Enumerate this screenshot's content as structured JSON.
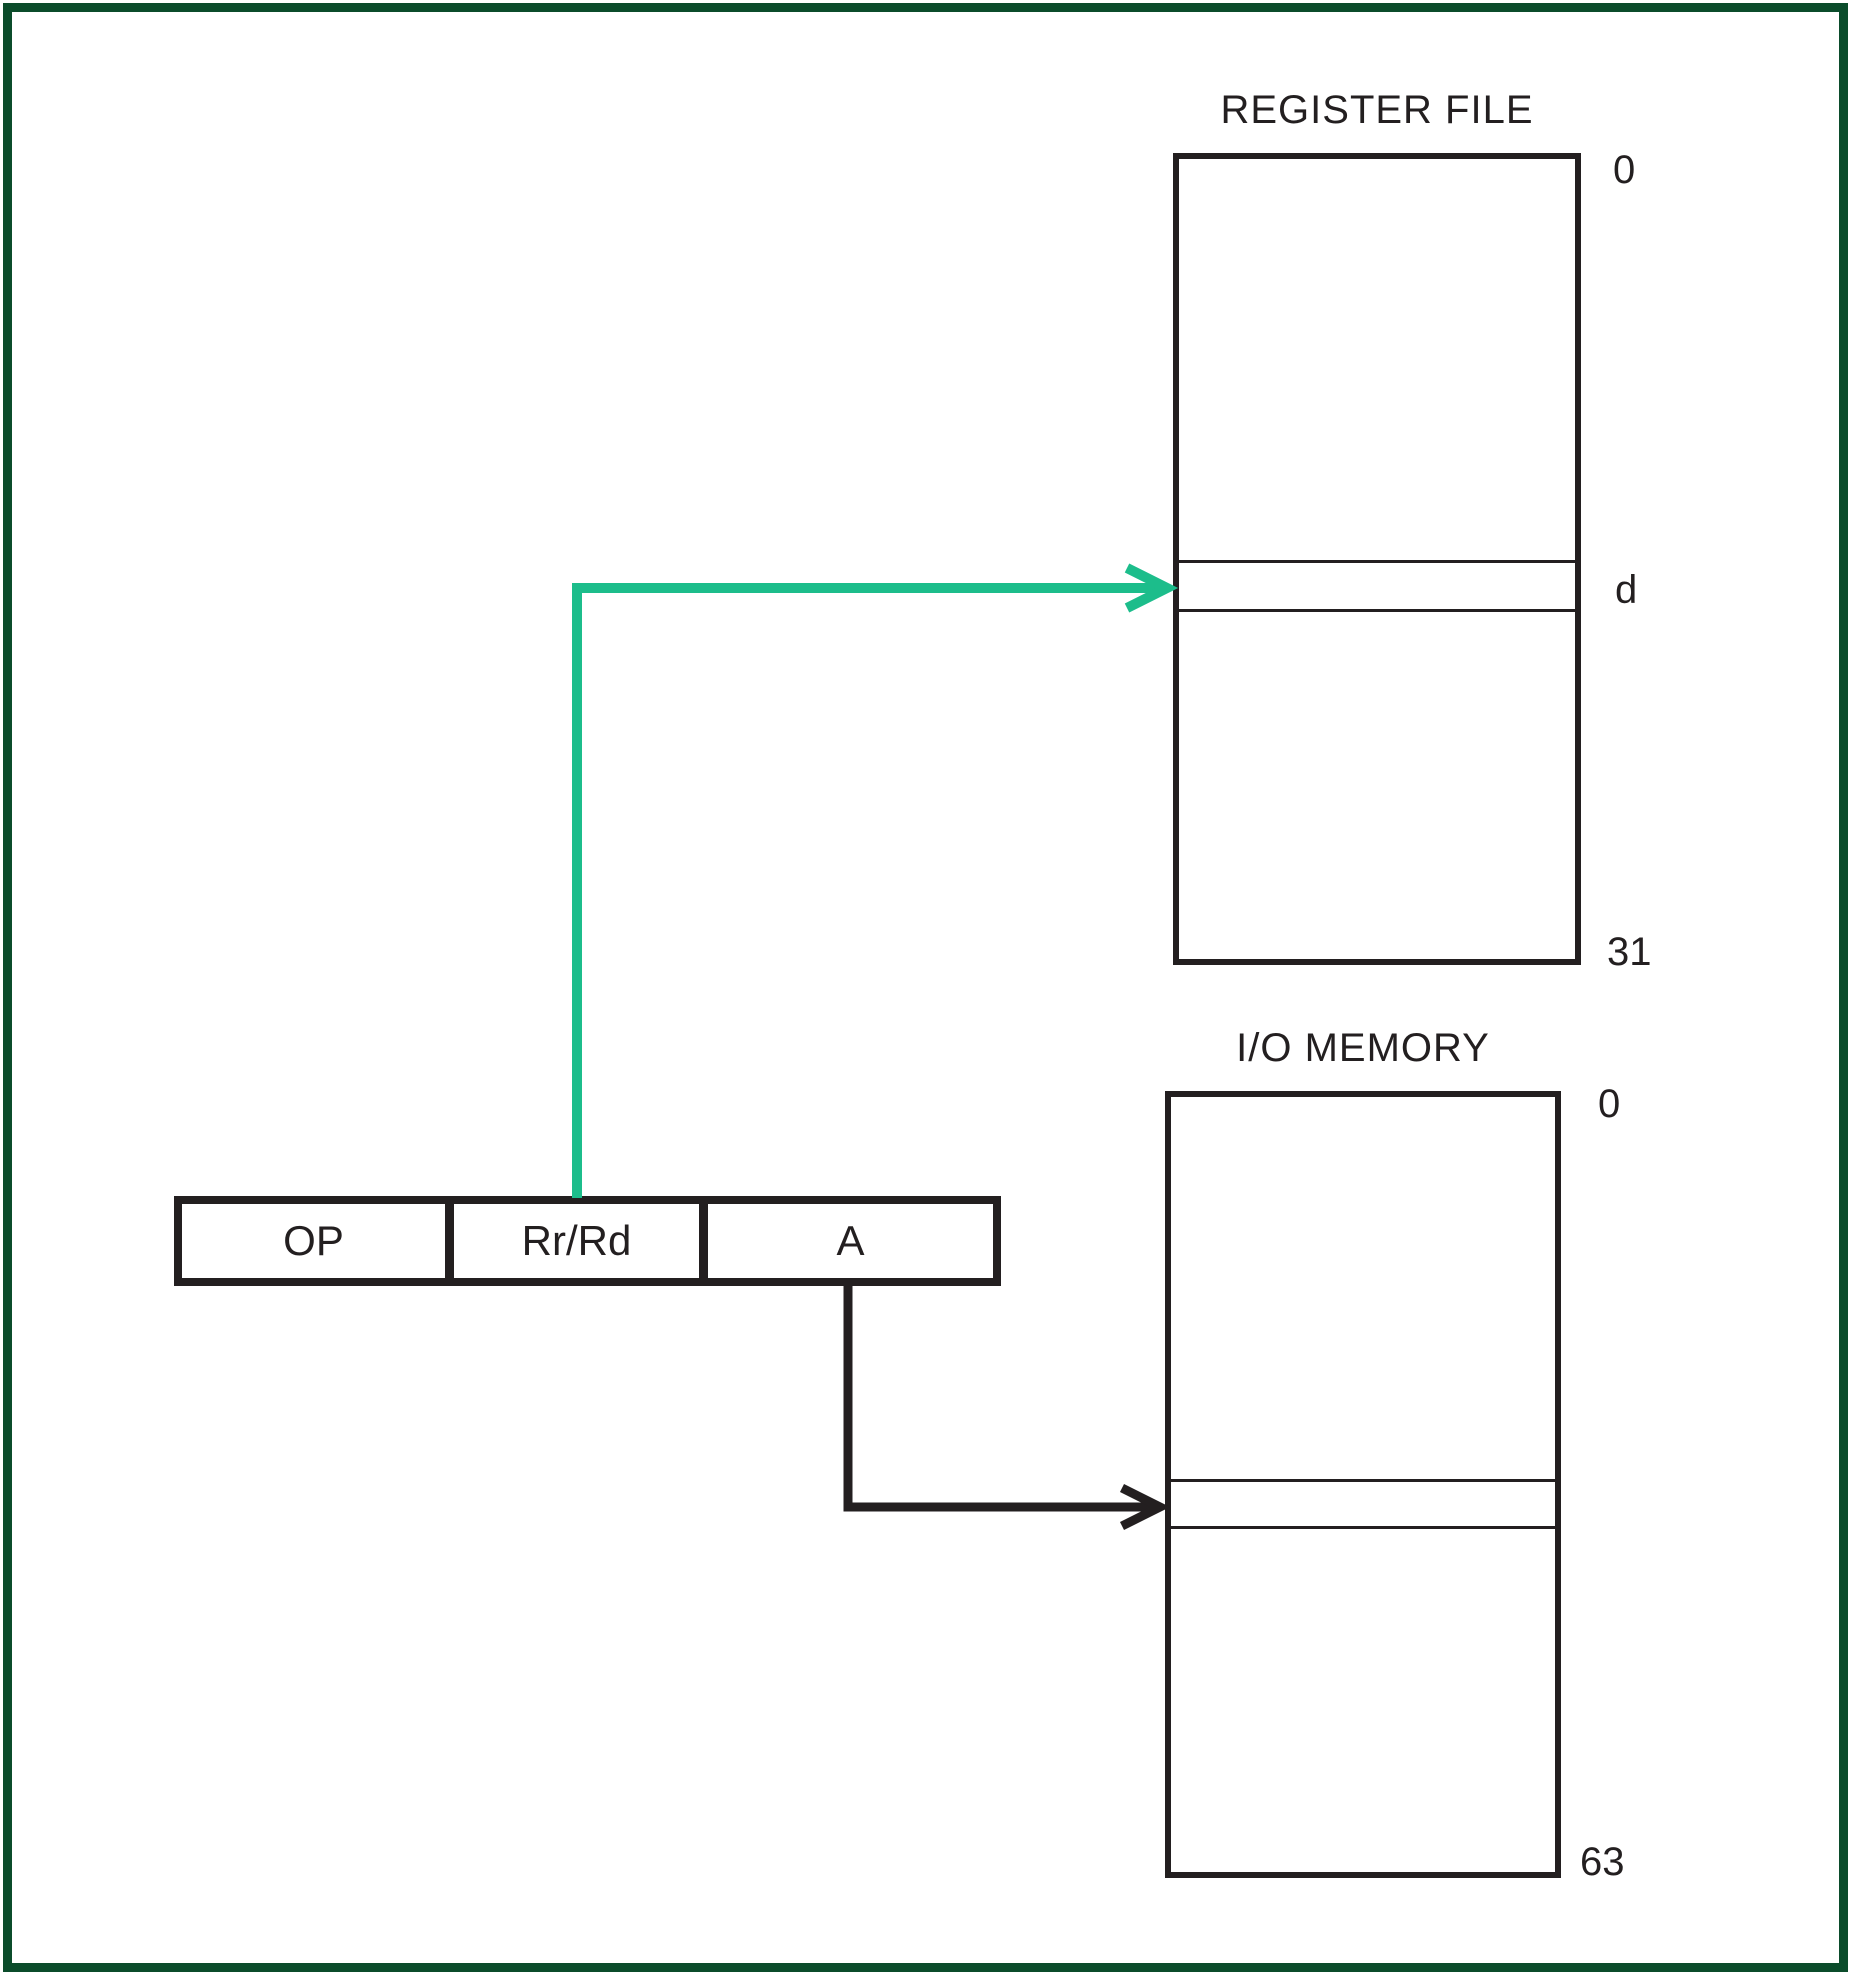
{
  "colors": {
    "frame_green": "#0b4c2b",
    "accent_green": "#1cbd8b",
    "line_black": "#231f20"
  },
  "register_file": {
    "title": "REGISTER FILE",
    "label_top": "0",
    "label_row": "d",
    "label_bottom": "31"
  },
  "io_memory": {
    "title": "I/O MEMORY",
    "label_top": "0",
    "label_bottom": "63"
  },
  "instruction": {
    "fields": [
      {
        "label": "OP"
      },
      {
        "label": "Rr/Rd"
      },
      {
        "label": "A"
      }
    ]
  }
}
